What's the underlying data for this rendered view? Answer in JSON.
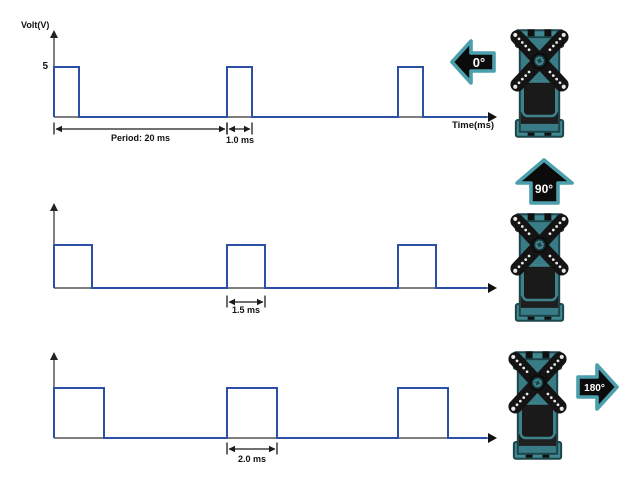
{
  "labels": {
    "volt_axis": "Volt(V)",
    "time_axis": "Time(ms)",
    "amplitude_tick": "5",
    "period": "Period: 20 ms"
  },
  "panels": [
    {
      "name": "servo-0-degrees",
      "angle_label": "0°",
      "pulse_width_label": "1.0 ms",
      "arrow_direction": "left",
      "waveform": {
        "type": "pwm-pulse-train",
        "period_ms": 20,
        "pulse_width_ms": 1.0,
        "amplitude_v": 5,
        "low_v": 0,
        "pulses_shown": 3
      }
    },
    {
      "name": "servo-90-degrees",
      "angle_label": "90°",
      "pulse_width_label": "1.5 ms",
      "arrow_direction": "up",
      "waveform": {
        "type": "pwm-pulse-train",
        "period_ms": 20,
        "pulse_width_ms": 1.5,
        "amplitude_v": 5,
        "low_v": 0,
        "pulses_shown": 3
      }
    },
    {
      "name": "servo-180-degrees",
      "angle_label": "180°",
      "pulse_width_label": "2.0 ms",
      "arrow_direction": "right",
      "waveform": {
        "type": "pwm-pulse-train",
        "period_ms": 20,
        "pulse_width_ms": 2.0,
        "amplitude_v": 5,
        "low_v": 0,
        "pulses_shown": 3
      }
    }
  ],
  "colors": {
    "signal_blue": "#2B50A5",
    "axis_gray": "#7E7E7E",
    "dimension_black": "#1C1C1C",
    "arrow_teal": "#4C9FAC",
    "arrow_fill": "#0B0B0B",
    "arrow_text": "#FFFFFF",
    "servo_teal": "#3A7C85",
    "horn_black": "#141414"
  }
}
